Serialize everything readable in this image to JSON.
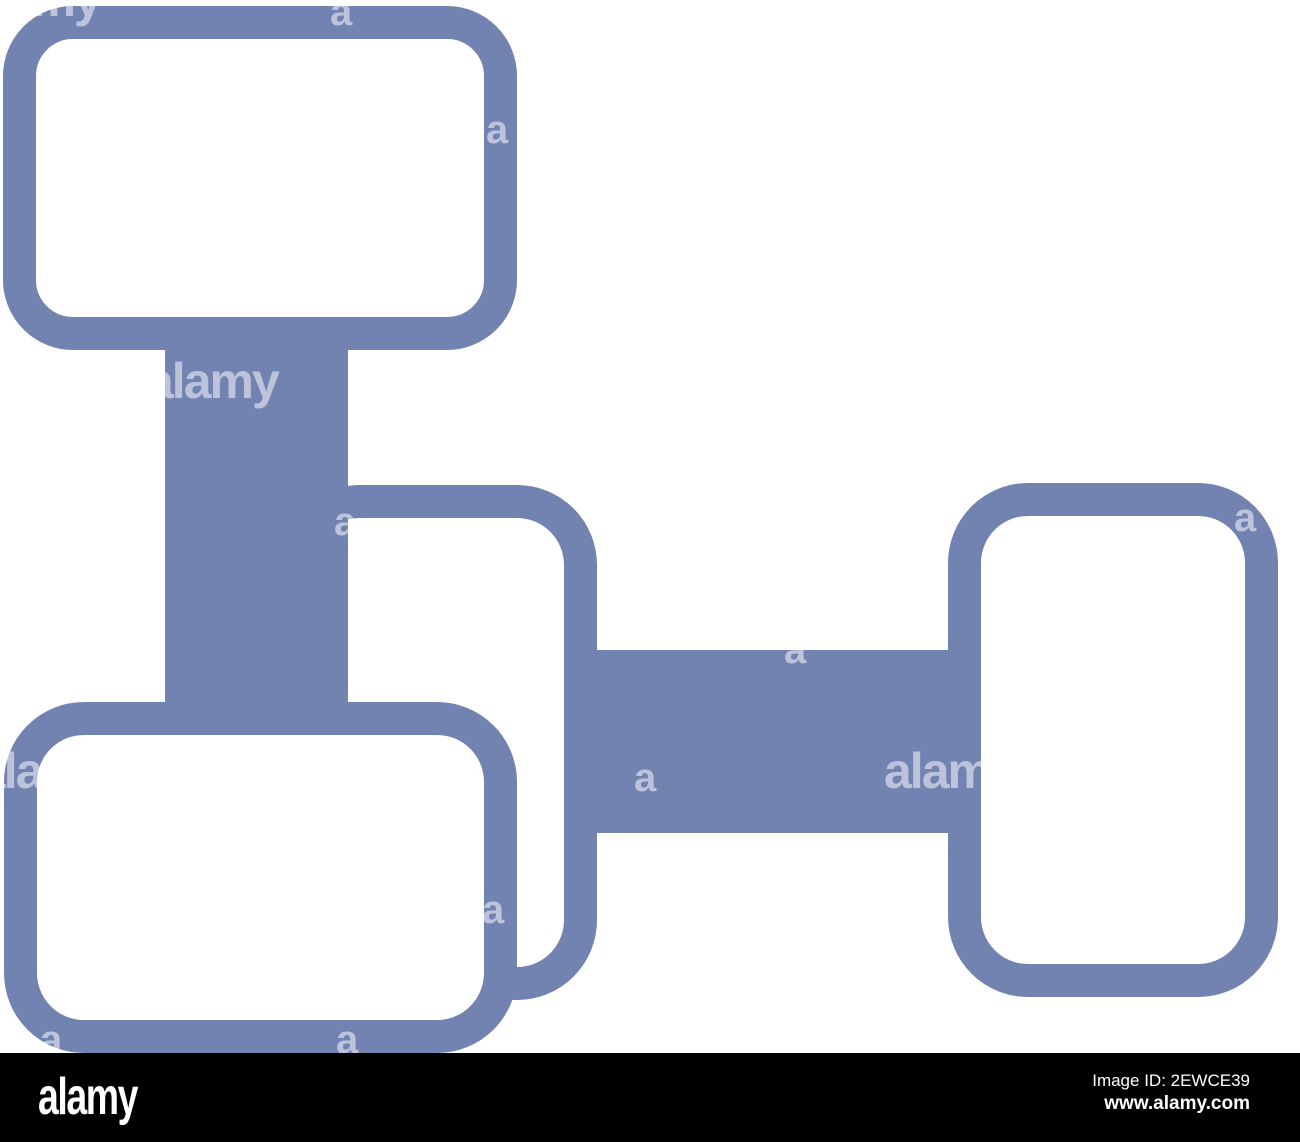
{
  "image": {
    "description": "Blue outline icon of four rounded rectangles connected by thick bars, on white background",
    "icon_color": "#7383B1",
    "background_color": "#FFFFFF",
    "watermark_color": "rgba(255,255,255,0.52)"
  },
  "watermarks": {
    "items": [
      {
        "text": "alamy"
      },
      {
        "text": "a"
      },
      {
        "text": "a"
      },
      {
        "text": "alamy"
      },
      {
        "text": "a"
      },
      {
        "text": "a"
      },
      {
        "text": "a"
      },
      {
        "text": "alamy"
      },
      {
        "text": "a"
      },
      {
        "text": "a"
      },
      {
        "text": "alamy"
      },
      {
        "text": "a"
      },
      {
        "text": "a"
      }
    ]
  },
  "footer": {
    "background": "#000000",
    "logo_text": "alamy",
    "image_id": "Image ID: 2EWCE39",
    "url": "www.alamy.com"
  }
}
